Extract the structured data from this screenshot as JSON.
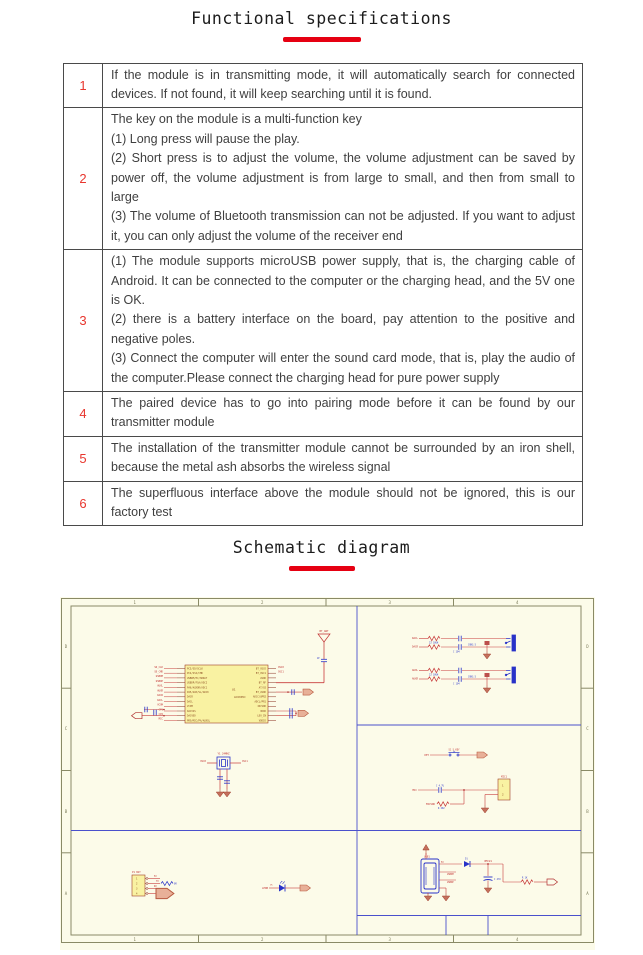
{
  "page": {
    "spec_title": "Functional specifications",
    "schematic_title": "Schematic diagram"
  },
  "colors": {
    "accent_red": "#e60012",
    "table_border": "#4a4a4a",
    "body_text": "#3f3f3f",
    "schematic_bg": "#fcfbe9",
    "schematic_wire_red": "#c83c3c",
    "schematic_blue": "#2832c8",
    "schematic_divider_blue": "#4a50cc",
    "schematic_part_yellow": "#f9f2a2"
  },
  "spec_table": {
    "rows": [
      {
        "num": "1",
        "text": "If the module is in transmitting mode, it will automatically search for connected devices. If not found, it will keep searching until it is found."
      },
      {
        "num": "2",
        "text": "The key on the module is a multi-function key\n(1) Long press will pause the play.\n(2) Short press is to adjust the volume, the volume adjustment can be saved by power off, the volume adjustment is from large to small, and then from small to large\n(3) The volume of Bluetooth transmission can not be adjusted. If you want to adjust it, you can only adjust the volume of the receiver end"
      },
      {
        "num": "3",
        "text": "(1) The module supports microUSB power supply, that is, the charging cable of Android. It can be connected to the computer or the charging head, and the 5V one is OK.\n(2) there is a battery interface on the board, pay attention to the positive and negative poles.\n(3) Connect the computer will enter the sound card mode, that is, play the audio of the computer.Please connect the charging head for pure power supply"
      },
      {
        "num": "4",
        "text": "The paired device has to go into pairing mode before it can be found by our transmitter module"
      },
      {
        "num": "5",
        "text": "The installation of the transmitter module cannot be surrounded by an iron shell, because the metal ash absorbs the wireless signal"
      },
      {
        "num": "6",
        "text": "The superfluous interface above the module should not be ignored, this is our factory test"
      }
    ]
  },
  "schematic": {
    "zones_top": [
      "1",
      "2",
      "3",
      "4"
    ],
    "zones_side": [
      "D",
      "C",
      "B",
      "A"
    ],
    "antenna": {
      "label": "BT_ANT",
      "cap": "1P"
    },
    "ic": {
      "ref": "U1",
      "part": "AC6905C",
      "left_nets": [
        "SD_CLK",
        "SD_CMD",
        "USBDM",
        "USBDP",
        "AUXL",
        "AUXR",
        "DACR",
        "DACL",
        "VCOM",
        "CP1",
        "CP2",
        "MIC"
      ],
      "left_pins": [
        "PC5/SD/SCLK",
        "PC4/SSI/CMD",
        "USBDM/PC/SBDAT",
        "USBDP/FSA/ADC2",
        "PA6/AUXDR/ADC1",
        "PA5/AUX/SL/ADC0",
        "DACR",
        "DACL",
        "VCOM",
        "DACVSS",
        "DACVDD",
        "PRO/MIC/PA/AUXSL"
      ],
      "right_pins": [
        "BT_OSCO",
        "BT_OSC1",
        "AVDD",
        "BT_RF",
        "AT/O2",
        "BT_AVDD",
        "ADCC/UPR2",
        "ADCL/PR1",
        "IOCVDD",
        "VDDO",
        "LDO_IN",
        "VDDIO"
      ],
      "osc0": "OSC0",
      "osc1": "OSC1"
    },
    "crystal": {
      "ref": "Y1 24MHZ",
      "left": "OSC0",
      "right": "OSC1"
    },
    "jack1": {
      "l1": "DACL",
      "l2": "DACR",
      "r_label": "22 10UH",
      "c_label": "C 104",
      "part": "CON3.5"
    },
    "jack2": {
      "l1": "AUXL",
      "l2": "AUXR",
      "r_label": "22 10UH",
      "c_label": "C 104",
      "part": "CON3.5"
    },
    "key": {
      "net": "KEY",
      "ref": "S1 S_KEY"
    },
    "mic": {
      "net": "MIC",
      "vdd": "MICVDD",
      "cap": "C 4.7U",
      "res": "R 2K2",
      "conn": "MIC1",
      "p1": "1",
      "p2": "2"
    },
    "usb": {
      "ref": "USB1",
      "diode": "D1",
      "vout": "VMCU1",
      "cap": "C 47U",
      "res": "R 1K",
      "dm": "USBDM",
      "dp": "USBDP",
      "v5": "5V"
    },
    "battery_conn": {
      "ref": "P1 BAT",
      "n1": "5V",
      "n2": "TX",
      "n3": "RX",
      "res": "0R",
      "p1": "1",
      "p2": "2",
      "p3": "3",
      "p4": "4"
    },
    "led": {
      "net": "LEDB",
      "res": "1K"
    }
  }
}
